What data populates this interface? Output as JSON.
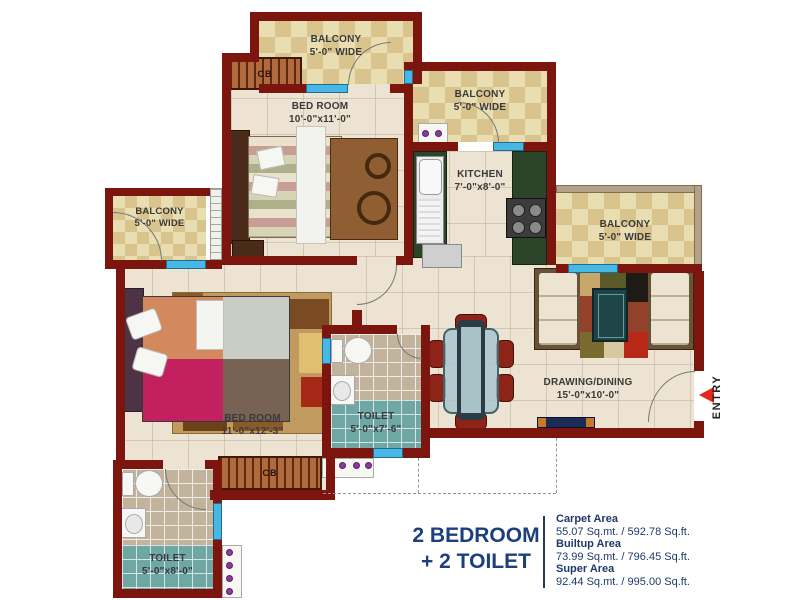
{
  "plan": {
    "labels": {
      "balcony_top": {
        "name": "BALCONY",
        "dim": "5'-0\" WIDE"
      },
      "balcony_kitchen": {
        "name": "BALCONY",
        "dim": "5'-0\" WIDE"
      },
      "balcony_left": {
        "name": "BALCONY",
        "dim": "5'-0\" WIDE"
      },
      "balcony_right": {
        "name": "BALCONY",
        "dim": "5'-0\" WIDE"
      },
      "bedroom_top": {
        "name": "BED ROOM",
        "dim": "10'-0\"x11'-0\""
      },
      "kitchen": {
        "name": "KITCHEN",
        "dim": "7'-0\"x8'-0\""
      },
      "bedroom_left": {
        "name": "BED ROOM",
        "dim": "11'-0\"x12'-3\""
      },
      "toilet_mid": {
        "name": "TOILET",
        "dim": "5'-0\"x7'-6\""
      },
      "toilet_bottom": {
        "name": "TOILET",
        "dim": "5'-0\"x8'-0\""
      },
      "drawing_dining": {
        "name": "DRAWING/DINING",
        "dim": "15'-0\"x10'-0\""
      }
    },
    "entry_label": "ENTRY",
    "cupboard_label": "CB"
  },
  "summary": {
    "title_line1": "2 BEDROOM",
    "title_line2": "+ 2 TOILET",
    "areas": [
      {
        "label": "Carpet Area",
        "value": "55.07 Sq.mt. / 592.78 Sq.ft."
      },
      {
        "label": "Builtup Area",
        "value": "73.99 Sq.mt. / 796.45 Sq.ft."
      },
      {
        "label": "Super Area",
        "value": "92.44 Sq.mt. / 995.00 Sq.ft."
      }
    ]
  },
  "colors": {
    "wall": "#7b150e",
    "window": "#49b7e4",
    "navy_text": "#1e3f7e",
    "counter_green": "#2c452a",
    "balcony_tile": "#d9c48e",
    "floor": "#ece3d2",
    "entry_arrow": "#e5271d"
  }
}
